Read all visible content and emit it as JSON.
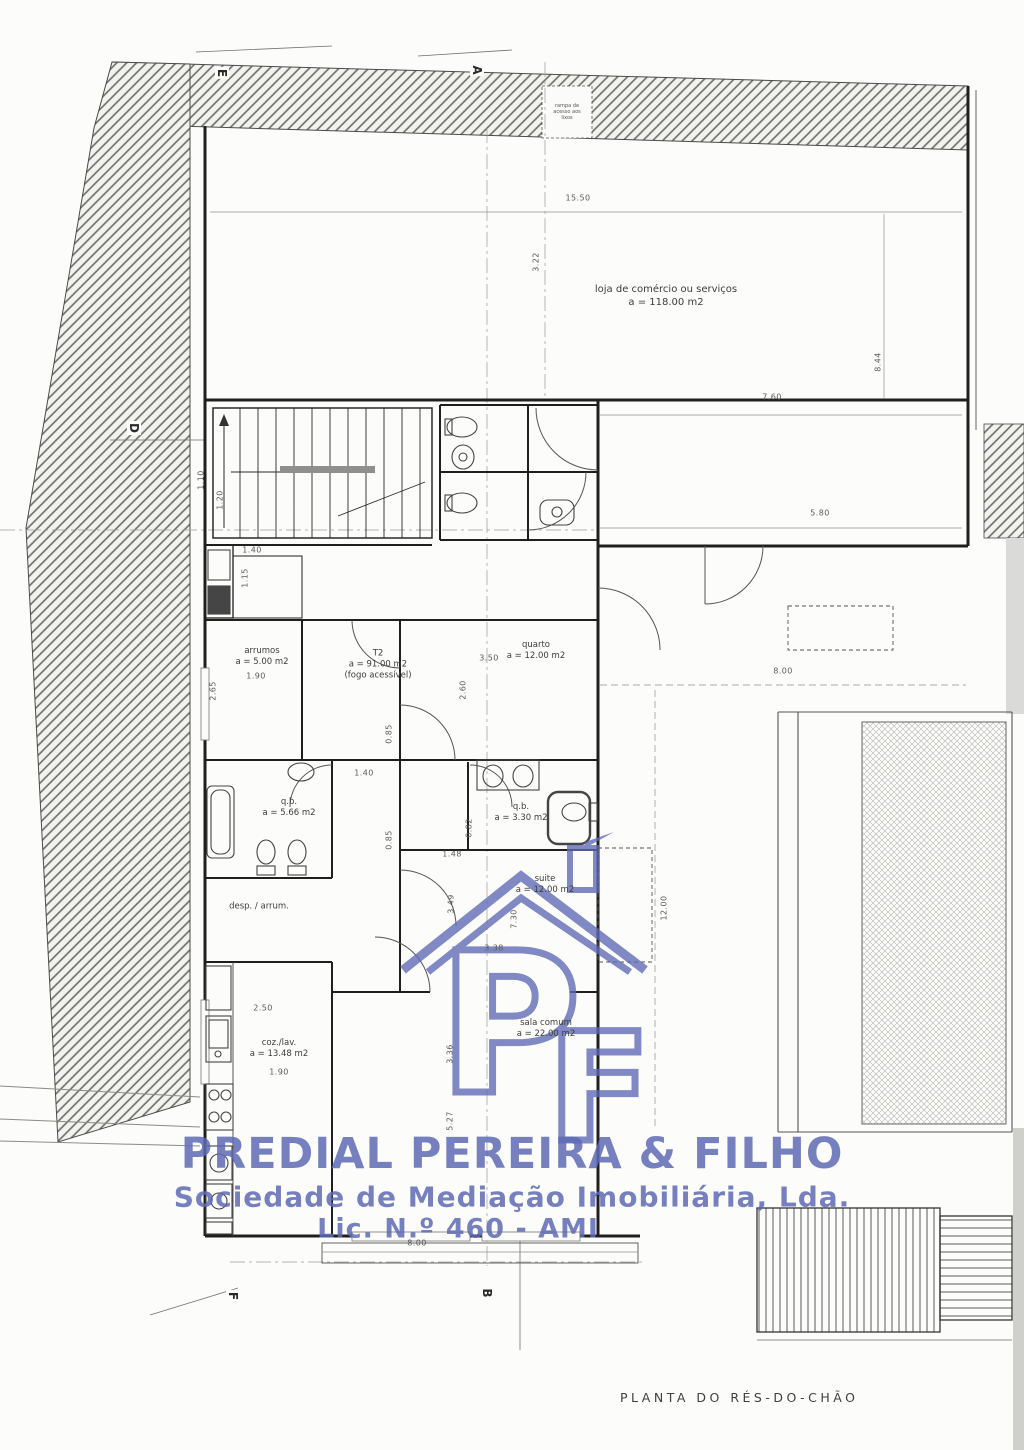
{
  "document": {
    "caption": "PLANTA DO RÉS-DO-CHÃO"
  },
  "watermark": {
    "company": "PREDIAL PEREIRA & FILHO",
    "subtitle": "Sociedade de Mediação Imobiliária, Lda.",
    "license": "Lic. N.º 460 - AMI",
    "monogram_p": "P",
    "monogram_f": "F",
    "color": "#5e6ab4"
  },
  "rooms": {
    "ramp_note": {
      "l1": "rampa de",
      "l2": "acesso aos",
      "l3": "lixos"
    },
    "loja": {
      "name": "loja de comércio ou serviços",
      "area": "a = 118.00 m2"
    },
    "arrumos": {
      "name": "arrumos",
      "area": "a = 5.00 m2"
    },
    "t2": {
      "name": "T2",
      "area": "a = 91.00 m2",
      "note": "(fogo acessível)"
    },
    "quarto": {
      "name": "quarto",
      "area": "a = 12.00 m2"
    },
    "qb1": {
      "name": "q.b.",
      "area": "a = 5.66 m2"
    },
    "qb2": {
      "name": "q.b.",
      "area": "a = 3.30 m2"
    },
    "suite": {
      "name": "suite",
      "area": "a = 12.00 m2"
    },
    "desp": {
      "name": "desp. / arrum."
    },
    "coz": {
      "name": "coz./lav.",
      "area": "a = 13.48 m2"
    },
    "sala": {
      "name": "sala comum",
      "area": "a = 22.00 m2"
    }
  },
  "sections": {
    "e": "E",
    "a": "A",
    "d": "D",
    "f": "F",
    "b": "B"
  },
  "dimensions": {
    "top_width": "15.50",
    "loja_depth": "3.22",
    "right_height": "8.44",
    "d760": "7.60",
    "d580": "5.80",
    "d800_right": "8.00",
    "d1200": "12.00",
    "d800_bottom": "8.00",
    "d140a": "1.40",
    "d115": "1.15",
    "d120": "1.20",
    "d110": "1.10",
    "d190a": "1.90",
    "d265": "2.65",
    "d350": "3.50",
    "d260": "2.60",
    "d085a": "0.85",
    "d140b": "1.40",
    "d085b": "0.85",
    "d148": "1.48",
    "d082": "0.82",
    "d349": "3.49",
    "d730": "7.30",
    "d338": "3.38",
    "d250": "2.50",
    "d190b": "1.90",
    "d336": "3.36",
    "d527": "5.27"
  }
}
